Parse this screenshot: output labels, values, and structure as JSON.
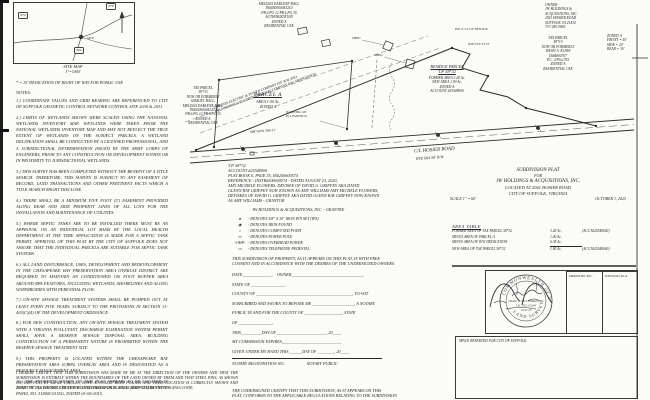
{
  "site_map": {
    "caption": "SITE  MAP",
    "scale": "1\"=1000'",
    "shields": [
      "674",
      "676",
      "604"
    ],
    "site_label": "SITE"
  },
  "dedication_note": "* = 10' DEDICATION OF RIGHT OF WAY FOR PUBLIC USE",
  "notes": {
    "title": "NOTES:",
    "items": [
      "1.) COORDINATE VALUES AND GRID BEARING ARE REFERENCED TO CITY OF SUFFOLK GEODETIC CONTROL NETWORK CONTROL SITE 2030 & 2031.",
      "2.) LIMITS OF WETLANDS SHOWN WERE SCALED USING THE NATIONAL WETLANDS INVENTORY MAP. WETLANDS WERE TAKEN FROM THE NATIONAL WETLANDS INVENTORY MAP AND MAY NOT REFLECT THE TRUE EXTENT OF WETLANDS ON THE SUBJECT PARCELS. A WETLAND DELINEATION SHALL BE CONDUCTED BY A LICENSED PROFESSIONAL, AND A JURISDICTIONAL DETERMINATION ISSUED BY THE ARMY CORPS OF ENGINEERS, PRIOR TO ANY CONSTRUCTION OR DEVELOPMENT WITHIN OR IN PROXIMITY TO JURISDICTIONAL WETLANDS.",
      "3.) THIS SURVEY HAS BEEN COMPLETED WITHOUT THE BENEFIT OF A TITLE SEARCH. THEREFORE, THIS SURVEY IS SUBJECT TO ANY EASEMENT OF RECORD, LAND TRANSACTIONS AND OTHER PERTINENT FACTS WHICH A TITLE SEARCH MIGHT DISCLOSE.",
      "4.) THERE SHALL BE A MINIMUM FIVE FOOT (5') EASEMENT PROVIDED ALONG REAR AND SIDE PROPERTY LINES OF ALL LOTS FOR THE INSTALLATION AND MAINTENANCE OF UTILITIES.",
      "5.) WHERE SEPTIC TANKS ARE TO BE INSTALLED THERE MUST BE AN APPROVAL ON AN INDIVIDUAL LOT BASIS BY THE LOCAL HEALTH DEPARTMENT AT THE TIME APPLICATION IS MADE FOR A SEPTIC TANK PERMIT. APPROVAL OF THIS PLAT BY THE CITY OF SUFFOLK DOES NOT ASSURE THAT THE INDIVIDUAL PARCELS ARE SUITABLE FOR SEPTIC TANK SYSTEMS.",
      "6.) ALL LAND DISTURBANCE, USES, DEVELOPMENT AND REDEVELOPMENT IN THE CHESAPEAKE BAY PRESERVATION AREA OVERLAY DISTRICT ARE REQUIRED TO MAINTAIN AN CONDITIONED 100 FOOT BUFFER AREA AROUND RPA FEATURES, INCLUDING WETLANDS, SHORELINES AND ALONG WATERBODIES WITH PERENNIAL FLOW.",
      "7.) ON-SITE SEWAGE TREATMENT SYSTEMS SHALL BE PUMPED OUT AT LEAST EVERY FIVE YEARS, SUBJECT TO THE PROVISIONS IN SECTION 31-403(C)(4) OF THE DEVELOPMENT ORDINANCE.",
      "8.) FOR NEW CONSTRUCTION, ANY ON-SITE SEWAGE TREATMENT SYSTEM WITH A VIRGINIA POLLUTANT DISCHARGE ELIMINATION SYSTEM PERMIT SHALL HAVE A RESERVE SEWAGE DISPOSAL AREA. BUILDING CONSTRUCTION OF A PERMANENT NATURE IS PROHIBITED WITHIN THE RESERVE SEWAGE TREATMENT SITE.",
      "9.) THIS PROPERTY IS LOCATED WITHIN THE CHESAPEAKE BAY PRESERVATION AREA (CBPA) OVERLAY AREA AND IS DESIGNATED AS A RESOURCE MANAGEMENT AREA.",
      "10.) THE PROPERTY SHOWN ON THIS PLAT APPEARS TO BE LOCATED IN ZONE \"X\" AS SHOWN ON THE FLOOD INSURANCE RATE MAP, COMMUNITY-PANEL NO. 51800C0155G, DATED 01-06-2015.",
      "11.) PARCELS SHOWN HEREON ARE NOT ON CITY WATER OR SEWER. PRIVATE WELL TO SERVICE BOTH PARCELS."
    ]
  },
  "surveyor_certification": "I HEREBY CERTIFY THAT THIS SUBDIVISION WAS MADE BY ME AT THE DIRECTION OF THE OWNERS AND THAT THE SUBDIVISION IS ENTIRELY WITHIN THE BOUNDARIES OF THE LAND OWNED BY THEM AND THAT STEEL PINS, AS SHOWN ON THIS PLAT BY SMALL CIRCLES, HAVE ACTUALLY BEEN PLACED AND THEIR LOCATION IS CORRECTLY SHOWN AND THAT THE PLAT DETAILS MEET THE STANDARDS FOR PLATS AS ADOPTED BY THE VIRGINIA CODE.",
  "plat": {
    "corridor_label": "VIRGINIA ELECTRIC & POWER COMPANY   100' R/W AND\n(AKA NORFOLK SOUTHERN RAILWAY COMPANY R/W, ABANDONED)",
    "adjoiner_north": "MELISSA DARLENE HALL\nIN#050000043210\nPB 6 PG 12   PB 6 PG 35\nAUTHORIZATION\nZONED A\nRESIDENTIAL USE",
    "adjoiner_west": "TAX PARCEL\n58*33\nNOW OR FORMERLY\nSAMUEL HALL,\nMELISSA DARLENE HALL\nIN#050000043210\nPB 6 PG 12   PB 6 PG 35\nZONED A\nRESIDENTIAL USE",
    "adjoiner_ne": "TAX PARCEL\n58*15\nNOW OR FORMERLY\nDAWN A. KUHN\nIN#4800707\nP.C. 2/PGs/755\nZONED A\nRESIDENTIAL USE",
    "parcel_a_title": "PARCEL A",
    "parcel_a_body": "AREA 1.00 Ac.\nZONED A",
    "residue_title": "RESIDUE PARCEL\nT.P. 58*32",
    "residue_body": "FORMER AREA 3.28 Ac.\nNEW AREA 1.90 Ac.\nZONED A\nACCOUNT #25548000",
    "road_name": "C/L HOSIER ROAD",
    "road_sub": "RTE 604          50' R/W",
    "road_bearing": "S84°56'W   364.31'",
    "grid_coords": "N) 3453821.28\nE) 12049059.52",
    "bearing_ne": "N36°23'E  53.33'",
    "new_rw_label": "P.B. 6 C/L OF NEW R/W",
    "shed_label": "SHED"
  },
  "owner_block": "OWNER -\nJW HOLDINGS &\nACQUISITIONS, INC.\n2941 HOSIER ROAD\nSUFFOLK VA 23434\n757-285-5865",
  "zoning_block": "ZONED A\nFRONT = 50'\nSIDE  = 20'\nREAR  = 30'",
  "deed_block": "T.P. 58*32\nACCOUNT #25548000\nPLAT BOOK 6, PAGE 35, IN#200600574\nREFERENCE - INSTR#200600574 - DATED AUGUST 23, 2020,\n      AMY MICHELE FLOWERS, DEVISEE OF DAVID G. GRIFFEY AKA DAVID\nGLENN RAY GRIFFEY NOW KNOWN AS AMY WILLIAMS AMY MICHELE FLOWERS,\nDEVISEES OF DAVID G. GRIFFEY AKA DAVID GLENN RAY GRIFFEY NOW KNOWN\nAS AMY WILLIAMS - GRANTOR",
  "grantee_line": "JW HOLDINGS & ACQUISITIONS, INC. - GRANTEE",
  "legend": {
    "items": [
      {
        "sym": "●",
        "text": "- DENOTES 5/8\" X 30\" IRON PIN SET (IPS)"
      },
      {
        "sym": "◉",
        "text": "- DENOTES IRON FOUND"
      },
      {
        "sym": "○",
        "text": "- DENOTES COMPUTED POINT"
      },
      {
        "sym": "-o-",
        "text": "- DENOTES POWER POLE"
      },
      {
        "sym": "-OHP-",
        "text": "- DENOTES OVERHEAD POWER"
      },
      {
        "sym": "▭",
        "text": "- DENOTES TELEPHONE PEDESTAL"
      }
    ]
  },
  "consent_paragraph": "THIS SUBDIVISION OF PROPERTY, AS IT APPEARS ON THIS PLAT, IS WITH FREE\nCONSENT AND IN ACCORDANCE WITH THE DESIRES OF THE UNDERSIGNED OWNERS.",
  "form": {
    "lines": [
      "DATE______________,    OWNER__________________________________,",
      "STATE OF ________________,",
      "COUNTY OF ______________________________________________, TO-WIT",
      "SUBSCRIBED AND SWORN TO BEFORE ME ____________________, A NOTARY",
      "PUBLIC IN AND FOR THE COUNTY OF __________________, STATE",
      "OF ________________,",
      "THIS__________DAY OF________________________, 20____.",
      "MY COMMISSION EXPIRES,____________________________",
      "GIVEN UNDER MY HAND THIS ______DAY OF ________, 20____.",
      "NOTARY REGISTRATION NO.                     NOTARY PUBLIC"
    ]
  },
  "closing_certification": "THE UNDERSIGNED CERTIFY THAT THIS SUBDIVISION, AS IT APPEARS ON THIS\nPLAT, CONFORMS TO THE APPLICABLE REGULATIONS RELATING TO THE SUBDIVISION",
  "title_block": {
    "line1": "SUBDIVISION PLAT",
    "line2": "FOR",
    "line3": "JW HOLDINGS & ACQUISITIONS, INC.",
    "line4": "LOCATED AT 2941 HOSIER ROAD",
    "line5": "CITY OF SUFFOLK, VIRGINIA",
    "scale": "SCALE 1\" = 60'",
    "date": "OCTOBER 1, 2025"
  },
  "area_table": {
    "title": "AREA TABLE",
    "rows": [
      {
        "label": "FORMER AREA OF TAX PARCEL 58*32",
        "value": "3.28 Ac.",
        "note": "(ACCT#25548000)"
      },
      {
        "label": "MINUS AREA OF PARCEL A",
        "value": "1.00 Ac.",
        "note": ""
      },
      {
        "label": "MINUS AREA OF R/W DEDICATION",
        "value": "0.38 Ac.",
        "note": ""
      },
      {
        "label": "NEW AREA OF TAX PARCEL 58*32",
        "value": "1.90 Ac.",
        "note": "(ACCT#25548000)"
      }
    ]
  },
  "seal": {
    "ring_top": "COMMONWEALTH OF VIRGINIA",
    "ring_bottom": "LAND SURVEYOR",
    "name": "CRAIG L. MCLENDON, JR.",
    "license": "LIC. NO. 02294",
    "date": "10-01-25"
  },
  "drawn_by": "DRAWN BY: RJC",
  "job_no": "JOB #GM-182-A",
  "city_box_label": "SPACE RESERVED FOR CITY OF SUFFOLK",
  "colors": {
    "ink": "#26262b",
    "line": "#2c2c2c",
    "faint": "#8a8a8a",
    "paper": "#fbfbf8"
  }
}
